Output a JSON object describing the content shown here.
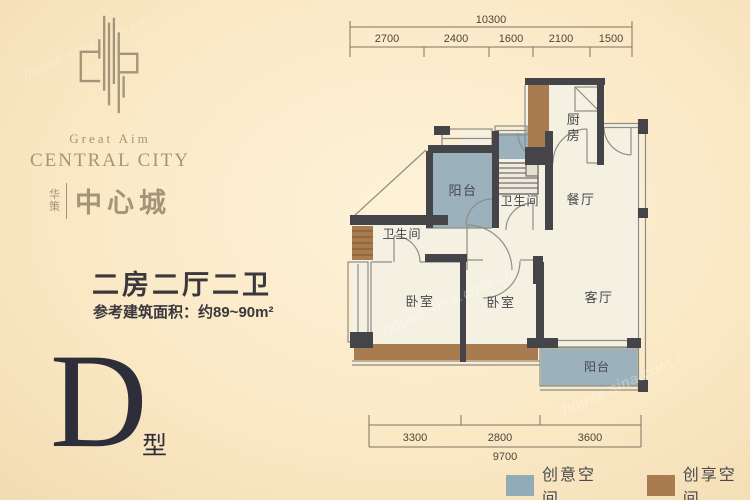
{
  "brand": {
    "tagline": "Great Aim",
    "name_en": "CENTRAL CITY",
    "cn_small_top": "华",
    "cn_small_bottom": "策",
    "cn_name": "中心城"
  },
  "summary": {
    "layout_title": "二房二厅二卫",
    "area_note": "参考建筑面积：约89~90m²"
  },
  "unit_type": {
    "letter": "D",
    "suffix": "型"
  },
  "floorplan": {
    "labels": {
      "kitchen_char1": "厨",
      "kitchen_char2": "房",
      "dining": "餐厅",
      "living": "客厅",
      "balcony_top": "阳台",
      "balcony_bottom": "阳台",
      "bath_upper": "卫生间",
      "bath_lower": "卫生间",
      "bedroom_left": "卧室",
      "bedroom_mid": "卧室"
    },
    "dims_top": {
      "total": "10300",
      "seg1": "2700",
      "seg2": "2400",
      "seg3": "1600",
      "seg4": "2100",
      "seg5": "1500"
    },
    "dims_bottom": {
      "total": "9700",
      "seg1": "3300",
      "seg2": "2800",
      "seg3": "3600"
    }
  },
  "legend": {
    "item1": {
      "label": "创意空间",
      "color": "#92abb8"
    },
    "item2": {
      "label": "创享空间",
      "color": "#a97c50"
    }
  },
  "colors": {
    "background": "#fbe9c6",
    "wall": "#454449",
    "floor": "#f5f1e2",
    "accent_blue": "#9bb2bc",
    "accent_brown": "#a97c50",
    "brand_gold": "#a3947a",
    "text_dark": "#3a383c"
  },
  "watermark": "house.sina.com.cn"
}
